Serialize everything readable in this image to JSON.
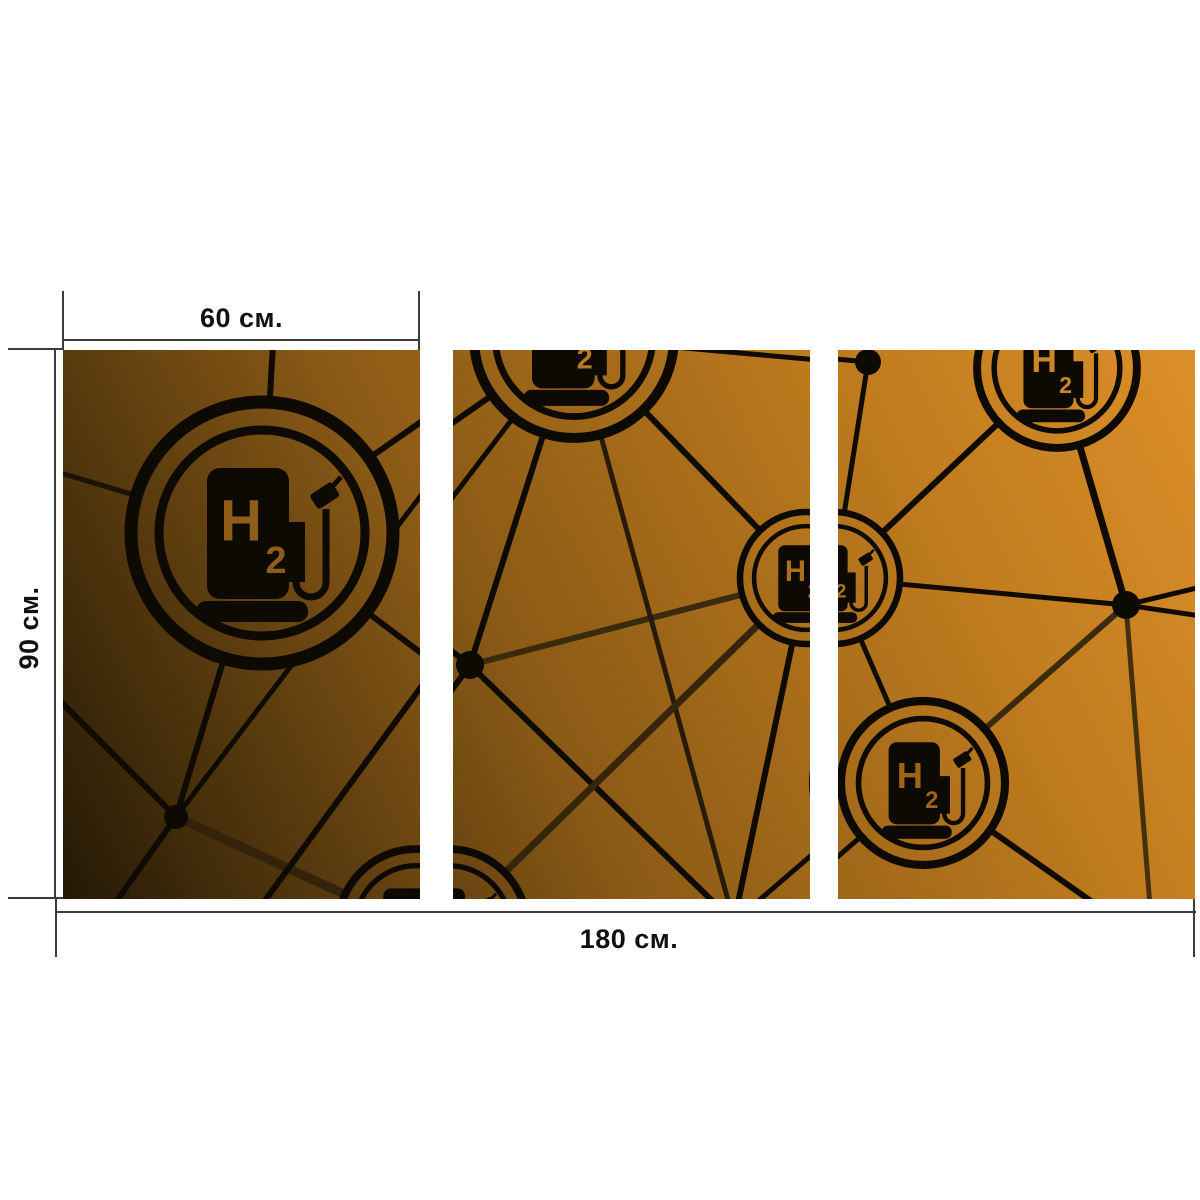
{
  "page": {
    "background": "#ffffff"
  },
  "dimensions": {
    "panel_width_label": "60 см.",
    "height_label": "90 см.",
    "total_width_label": "180 см."
  },
  "artwork": {
    "subject": "hydrogen-fuel-station-network-triptych",
    "icon_letter_main": "H",
    "icon_letter_sub": "2",
    "colors": {
      "gradient_dark": "#241906",
      "gradient_mid": "#8a5a16",
      "gradient_bright": "#dc8f2a",
      "line_black": "#100b02",
      "line_brown": "#3a2a0e",
      "dimension_line": "#3c3c3c"
    }
  }
}
